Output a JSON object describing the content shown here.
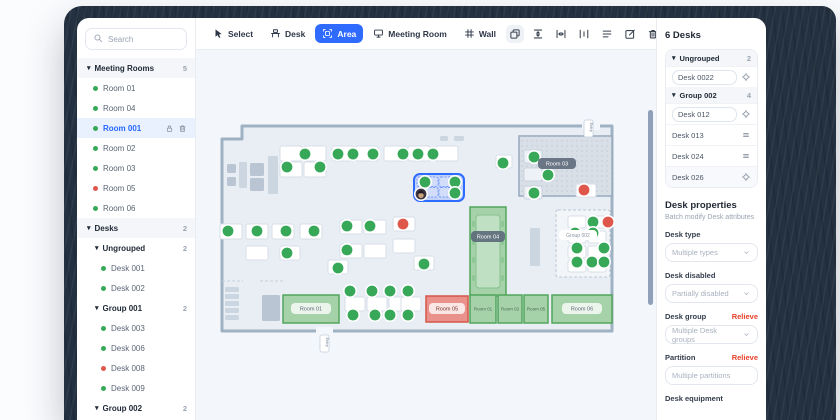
{
  "colors": {
    "accent": "#2f6bff",
    "green": "#36a857",
    "red": "#df574b",
    "relieve": "#e8402a"
  },
  "sidebar": {
    "search_placeholder": "Search",
    "rows": [
      {
        "type": "header",
        "label": "Meeting Rooms",
        "count": "5"
      },
      {
        "type": "item",
        "label": "Room 01",
        "dot": "green"
      },
      {
        "type": "item",
        "label": "Room 04",
        "dot": "green"
      },
      {
        "type": "item",
        "label": "Room 001",
        "dot": "green",
        "selected": true,
        "icons": [
          "lock-icon",
          "trash-icon"
        ]
      },
      {
        "type": "item",
        "label": "Room 02",
        "dot": "green"
      },
      {
        "type": "item",
        "label": "Room 03",
        "dot": "green"
      },
      {
        "type": "item",
        "label": "Room 05",
        "dot": "red"
      },
      {
        "type": "item",
        "label": "Room 06",
        "dot": "green"
      },
      {
        "type": "header",
        "label": "Desks",
        "count": "2"
      },
      {
        "type": "subheader",
        "label": "Ungrouped",
        "count": "2"
      },
      {
        "type": "item2",
        "label": "Desk 001",
        "dot": "green"
      },
      {
        "type": "item2",
        "label": "Desk 002",
        "dot": "green"
      },
      {
        "type": "subheader",
        "label": "Group 001",
        "count": "2"
      },
      {
        "type": "item2",
        "label": "Desk 003",
        "dot": "green"
      },
      {
        "type": "item2",
        "label": "Desk 006",
        "dot": "green"
      },
      {
        "type": "item2",
        "label": "Desk 008",
        "dot": "red"
      },
      {
        "type": "item2",
        "label": "Desk 009",
        "dot": "green"
      },
      {
        "type": "subheader",
        "label": "Group 002",
        "count": "2"
      }
    ]
  },
  "toolbar": {
    "tools": [
      {
        "label": "Select",
        "icon": "pointer-icon",
        "active": false
      },
      {
        "label": "Desk",
        "icon": "desk-icon",
        "active": false
      },
      {
        "label": "Area",
        "icon": "area-icon",
        "active": true
      },
      {
        "label": "Meeting Room",
        "icon": "screen-icon",
        "active": false
      },
      {
        "label": "Wall",
        "icon": "wall-icon",
        "active": false
      }
    ],
    "actions": [
      {
        "icon": "copy-icon",
        "bg": true
      },
      {
        "icon": "distribute-vertical-icon",
        "bg": false
      },
      {
        "icon": "distribute-horizontal-icon",
        "bg": false
      },
      {
        "icon": "spacing-icon",
        "bg": false
      },
      {
        "icon": "align-lines-icon",
        "bg": false
      },
      {
        "icon": "edit-icon",
        "bg": false
      },
      {
        "icon": "trash-icon",
        "bg": false
      }
    ]
  },
  "right_panel": {
    "title": "6 Desks",
    "list": [
      {
        "type": "group",
        "label": "Ungrouped",
        "count": "2"
      },
      {
        "type": "input",
        "value": "Desk 0022",
        "icon": "target-icon"
      },
      {
        "type": "group",
        "label": "Group 002",
        "count": "4"
      },
      {
        "type": "input",
        "value": "Desk 012",
        "icon": "target-icon"
      },
      {
        "type": "row",
        "value": "Desk 013",
        "icon": "drag-icon"
      },
      {
        "type": "row",
        "value": "Desk 024",
        "icon": "drag-icon"
      },
      {
        "type": "row",
        "value": "Desk 026",
        "icon": "target-icon",
        "shaded": true
      }
    ],
    "properties": {
      "title": "Desk properties",
      "subtitle": "Batch modify Desk attributes",
      "fields": [
        {
          "label": "Desk type",
          "placeholder": "Multiple types",
          "control": "select"
        },
        {
          "label": "Desk disabled",
          "placeholder": "Partially disabled",
          "control": "select"
        },
        {
          "label": "Desk group",
          "placeholder": "Multiple Desk groups",
          "control": "select",
          "action": "Relieve"
        },
        {
          "label": "Partition",
          "placeholder": "Multiple partitions",
          "control": "input",
          "action": "Relieve"
        },
        {
          "label": "Desk equipment",
          "control": "none"
        }
      ]
    }
  },
  "plan": {
    "wall_points": "46,76 416,76 416,281 26,281 26,89 46,89",
    "door_gaps": [
      [
        386,
        72,
        18,
        8
      ],
      [
        120,
        277,
        17,
        8
      ]
    ],
    "dashes": [
      [
        26,
        231,
        47,
        231
      ],
      [
        64,
        231,
        87,
        231
      ]
    ],
    "tags": [
      {
        "x": 388,
        "y": 70,
        "label": "Entry"
      },
      {
        "x": 124,
        "y": 285,
        "label": "Entry"
      }
    ],
    "furniture": [
      [
        31,
        114,
        9,
        9,
        "d"
      ],
      [
        31,
        127,
        9,
        9,
        "d"
      ],
      [
        43,
        112,
        8,
        26,
        "l"
      ],
      [
        54,
        113,
        14,
        13,
        "d"
      ],
      [
        54,
        128,
        14,
        13,
        "d"
      ],
      [
        72,
        106,
        10,
        38,
        "l"
      ],
      [
        244,
        86,
        8,
        5,
        "l"
      ],
      [
        258,
        86,
        10,
        5,
        "l"
      ],
      [
        334,
        178,
        10,
        38,
        "l"
      ],
      [
        29,
        237,
        14,
        5,
        "l"
      ],
      [
        29,
        244,
        14,
        5,
        "l"
      ],
      [
        29,
        251,
        14,
        5,
        "l"
      ],
      [
        29,
        258,
        14,
        5,
        "l"
      ],
      [
        29,
        265,
        14,
        5,
        "l"
      ],
      [
        66,
        245,
        18,
        26,
        "d"
      ],
      [
        374,
        100,
        8,
        34,
        "g"
      ],
      [
        386,
        104,
        6,
        10,
        "g"
      ],
      [
        396,
        96,
        12,
        44,
        "g"
      ]
    ],
    "rooms": [
      {
        "x": 323,
        "y": 86,
        "w": 93,
        "h": 60,
        "type": "grey",
        "label": "Room 03",
        "style": "dark",
        "lx": 342,
        "ly": 108,
        "lw": 38
      },
      {
        "x": 274,
        "y": 157,
        "w": 36,
        "h": 89,
        "type": "green",
        "label": "Room 04",
        "style": "dark",
        "lx": 275,
        "ly": 181,
        "lw": 34,
        "table": true
      },
      {
        "x": 87,
        "y": 245,
        "w": 56,
        "h": 28,
        "type": "green",
        "label": "Room 01",
        "style": "light",
        "lx": 95,
        "ly": 253,
        "lw": 40
      },
      {
        "x": 230,
        "y": 246,
        "w": 42,
        "h": 26,
        "type": "red",
        "label": "Room 05",
        "style": "light",
        "lx": 233,
        "ly": 253,
        "lw": 36
      },
      {
        "x": 274,
        "y": 245,
        "w": 26,
        "h": 28,
        "type": "green",
        "label": "Room 01",
        "style": "tiny"
      },
      {
        "x": 302,
        "y": 245,
        "w": 24,
        "h": 28,
        "type": "green",
        "label": "Room 02",
        "style": "tiny"
      },
      {
        "x": 328,
        "y": 245,
        "w": 24,
        "h": 28,
        "type": "green",
        "label": "Room 05",
        "style": "tiny"
      },
      {
        "x": 356,
        "y": 245,
        "w": 60,
        "h": 28,
        "type": "green",
        "label": "Room 06",
        "style": "light",
        "lx": 366,
        "ly": 253,
        "lw": 40
      }
    ],
    "group_area": {
      "x": 360,
      "y": 160,
      "w": 54,
      "h": 67,
      "label": "Group 002",
      "lx": 363,
      "ly": 180,
      "lw": 38
    },
    "selection": {
      "x": 218,
      "y": 124,
      "w": 50,
      "h": 27
    },
    "desks": [
      [
        84,
        96,
        22,
        15
      ],
      [
        108,
        96,
        22,
        15
      ],
      [
        136,
        96,
        22,
        15
      ],
      [
        160,
        96,
        22,
        15
      ],
      [
        188,
        96,
        22,
        15
      ],
      [
        212,
        96,
        22,
        15
      ],
      [
        240,
        96,
        22,
        15
      ],
      [
        84,
        112,
        22,
        15
      ],
      [
        108,
        112,
        22,
        15
      ],
      [
        300,
        105,
        16,
        13
      ],
      [
        24,
        174,
        22,
        15
      ],
      [
        50,
        174,
        22,
        15
      ],
      [
        76,
        174,
        22,
        15
      ],
      [
        104,
        174,
        22,
        15
      ],
      [
        50,
        196,
        22,
        14
      ],
      [
        84,
        196,
        20,
        14
      ],
      [
        144,
        170,
        22,
        14
      ],
      [
        168,
        170,
        22,
        14
      ],
      [
        144,
        194,
        22,
        14
      ],
      [
        168,
        194,
        22,
        14
      ],
      [
        197,
        167,
        22,
        14
      ],
      [
        197,
        189,
        22,
        14
      ],
      [
        218,
        206,
        20,
        14
      ],
      [
        132,
        210,
        20,
        14
      ],
      [
        380,
        134,
        20,
        13
      ],
      [
        149,
        247,
        20,
        14
      ],
      [
        171,
        247,
        20,
        14
      ],
      [
        193,
        247,
        20,
        14
      ],
      [
        205,
        247,
        20,
        14
      ]
    ],
    "room_desks": [
      [
        328,
        100,
        18,
        13
      ],
      [
        328,
        118,
        18,
        13
      ],
      [
        328,
        136,
        18,
        13
      ]
    ],
    "group_desks": [
      [
        372,
        166,
        18,
        12
      ],
      [
        392,
        166,
        18,
        12
      ],
      [
        372,
        181,
        18,
        12
      ],
      [
        392,
        181,
        18,
        12
      ],
      [
        372,
        196,
        18,
        12
      ],
      [
        392,
        196,
        18,
        12
      ],
      [
        372,
        210,
        18,
        12
      ],
      [
        392,
        210,
        18,
        12
      ]
    ],
    "seats": [
      [
        109,
        104,
        "g"
      ],
      [
        142,
        104,
        "g"
      ],
      [
        157,
        104,
        "g"
      ],
      [
        177,
        104,
        "g"
      ],
      [
        207,
        104,
        "g"
      ],
      [
        222,
        104,
        "g"
      ],
      [
        237,
        104,
        "g"
      ],
      [
        91,
        117,
        "g"
      ],
      [
        124,
        117,
        "g"
      ],
      [
        307,
        113,
        "g"
      ],
      [
        229,
        132,
        "g"
      ],
      [
        259,
        132,
        "g"
      ],
      [
        259,
        143,
        "g"
      ],
      [
        225,
        144,
        "a"
      ],
      [
        32,
        181,
        "g"
      ],
      [
        61,
        181,
        "g"
      ],
      [
        90,
        181,
        "g"
      ],
      [
        118,
        181,
        "g"
      ],
      [
        91,
        203,
        "g"
      ],
      [
        151,
        176,
        "g"
      ],
      [
        174,
        176,
        "g"
      ],
      [
        151,
        200,
        "g"
      ],
      [
        207,
        174,
        "r"
      ],
      [
        228,
        214,
        "g"
      ],
      [
        142,
        218,
        "g"
      ],
      [
        388,
        140,
        "r"
      ],
      [
        338,
        107,
        "g"
      ],
      [
        352,
        125,
        "g"
      ],
      [
        338,
        143,
        "g"
      ],
      [
        397,
        172,
        "g"
      ],
      [
        412,
        172,
        "r"
      ],
      [
        379,
        183,
        "g"
      ],
      [
        397,
        183,
        "g"
      ],
      [
        381,
        198,
        "g"
      ],
      [
        408,
        198,
        "g"
      ],
      [
        381,
        212,
        "g"
      ],
      [
        396,
        212,
        "g"
      ],
      [
        408,
        212,
        "g"
      ],
      [
        154,
        241,
        "g"
      ],
      [
        176,
        241,
        "g"
      ],
      [
        194,
        241,
        "g"
      ],
      [
        212,
        241,
        "g"
      ],
      [
        157,
        265,
        "g"
      ],
      [
        179,
        265,
        "g"
      ],
      [
        194,
        265,
        "g"
      ],
      [
        212,
        265,
        "g"
      ]
    ]
  }
}
